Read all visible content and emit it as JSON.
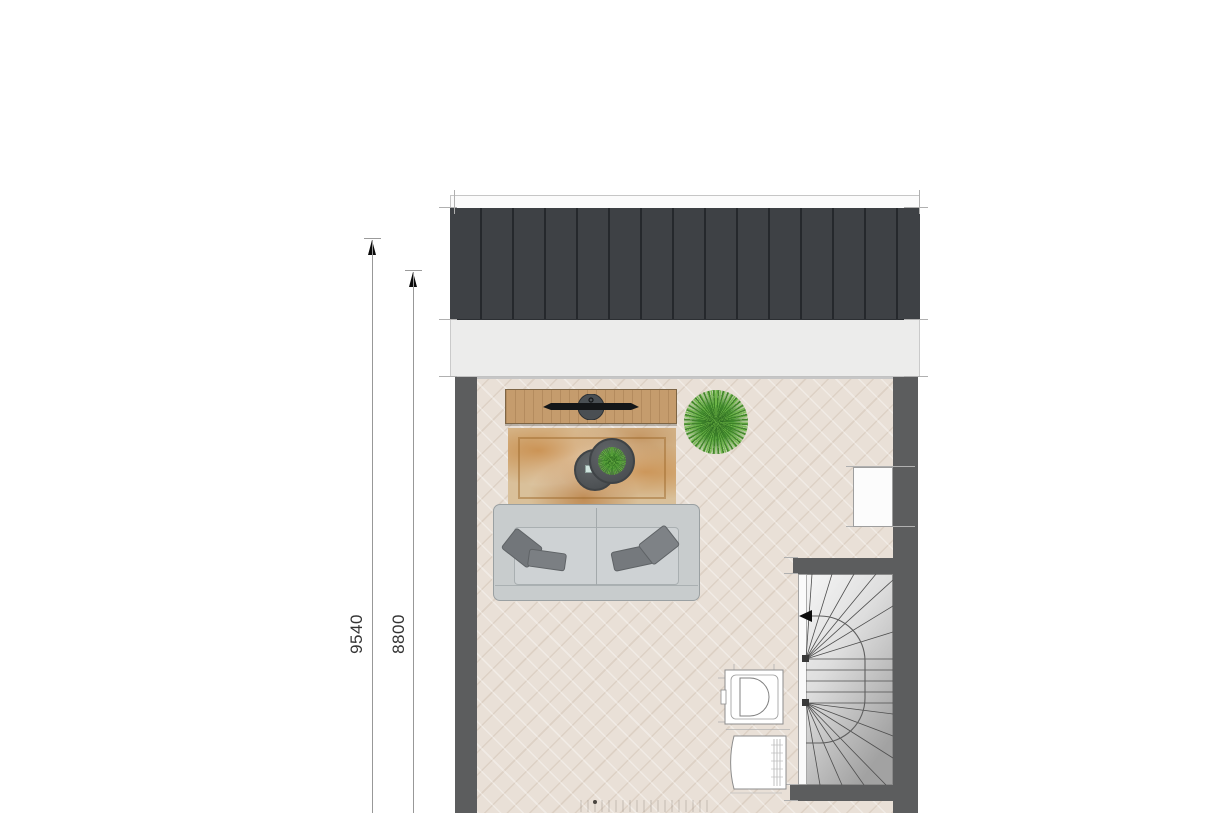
{
  "annotations": {
    "dimensions": [
      {
        "label": "9540",
        "orientation": "vertical",
        "arrow": "up"
      },
      {
        "label": "8800",
        "orientation": "vertical",
        "arrow": "up"
      }
    ]
  },
  "floor_plan": {
    "objects": [
      "roof-panel",
      "facade-strip",
      "left-wall",
      "right-wall",
      "tv-cabinet",
      "television",
      "area-rug",
      "coffee-table-small",
      "coffee-table-large-with-plant",
      "potted-plant",
      "sofa-with-pillows",
      "closet-niche",
      "staircase-with-winders",
      "stair-direction-arrow",
      "toilet",
      "washbasin-cabinet"
    ],
    "palette": {
      "background": "#ffffff",
      "roof": "#3e4145",
      "wall": "#5c5d5e",
      "floor": "#e9e0d7",
      "rug_accent": "#c5823a",
      "wood": "#c59c6d",
      "sofa": "#c8cccd",
      "pillow": "#75797c",
      "plant_green": "#3f8a2e",
      "stair_light": "#f7f7f7",
      "stair_dark": "#a2a2a2",
      "dimension_line": "#989898",
      "dimension_text": "#333333"
    }
  }
}
